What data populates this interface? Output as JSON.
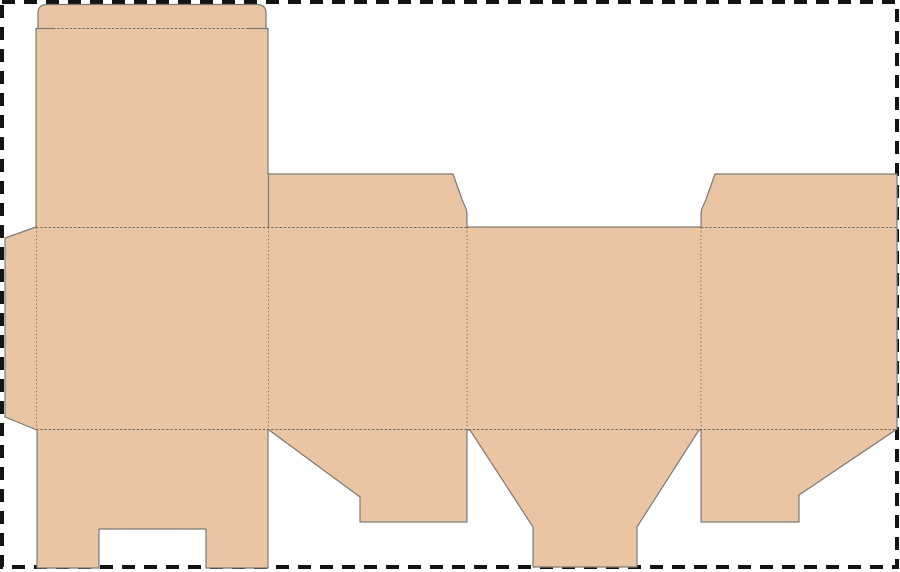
{
  "canvas": {
    "width": 900,
    "height": 572,
    "background_color": "#ffffff"
  },
  "colors": {
    "board_fill": "#e9c5a3",
    "cut_stroke": "#7d7a74",
    "fold_stroke": "#6f6c66",
    "border_stroke": "#141414",
    "background_color": "#ffffff"
  },
  "dieline": {
    "outline": "M36 227 V28.5 H38 V13 Q38 4.5 47 4.5 H257 Q266 4.5 266 13 V28.5 H268 V174 H453 L463 202 Q467 209 467 215 V227 H701 V215 Q701 209 705 202 L715 174 H897 V429 L799 495 V522 H701 V430 H699 L637 527 V567 H533 V527 L470 430 H467 V522 H360 V497 L269 430 H268 V568 H206 V529 H99 V568 H37 V430 L5 417 V238 Z",
    "cuts": [
      "M36 28.5 H53",
      "M248 28.5 H268",
      "M268.5 174 V227"
    ],
    "folds": {
      "tuck_lid": "M53 28.5 H248",
      "top_horizontal_left": "M36 227.5 H467",
      "top_horizontal_right": "M701 227.5 H897",
      "bottom_horizontal": "M36 429.5 H897",
      "glue_flap_vertical": "M36.5 227.5 V429.5",
      "panel_1_2_vertical": "M268.5 227.5 V429.5",
      "panel_2_3_vertical": "M467 227.5 V429.5",
      "panel_3_4_vertical": "M701 227.5 V429.5"
    }
  },
  "sheet_border": {
    "dash_pattern": "13 9",
    "stroke_width": 4
  }
}
